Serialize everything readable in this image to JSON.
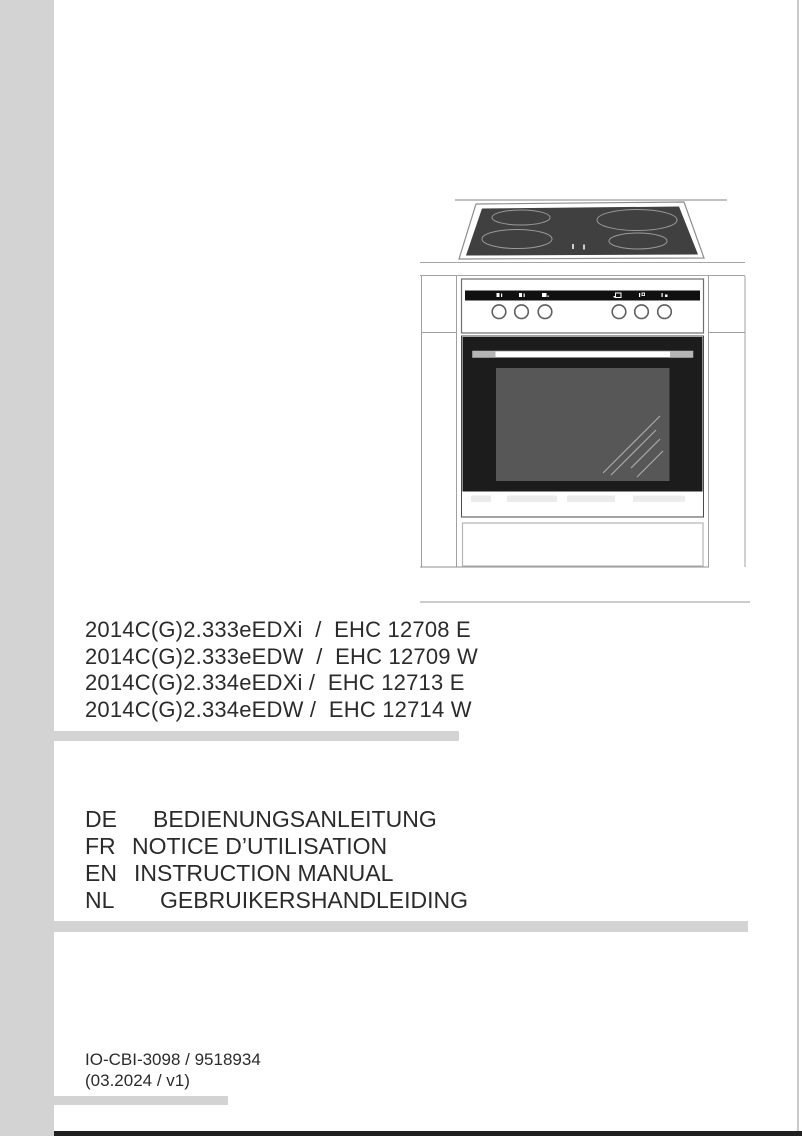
{
  "models": [
    "2014C(G)2.333eEDXi  /  EHC 12708 E",
    "2014C(G)2.333eEDW  /  EHC 12709 W",
    "2014C(G)2.334eEDXi /  EHC 12713 E",
    "2014C(G)2.334eEDW /  EHC 12714 W"
  ],
  "languages": [
    {
      "code": "DE",
      "title": "BEDIENUNGSANLEITUNG"
    },
    {
      "code": "FR",
      "title": "NOTICE D’UTILISATION"
    },
    {
      "code": "EN",
      "title": "INSTRUCTION MANUAL"
    },
    {
      "code": "NL",
      "title": "GEBRUIKERSHANDLEIDING"
    }
  ],
  "document": {
    "number": "IO-CBI-3098 / 9518934",
    "version": "(03.2024 / v1)"
  },
  "colors": {
    "rail_gray": "#d3d3d3",
    "footer_bar": "#202020",
    "door_black": "#1c1c1c",
    "hob_glass": "#404040",
    "window_gray": "#575757"
  },
  "illustration": {
    "subject": "freestanding-cooker-line-drawing",
    "icons": [
      "hob-zone-icon-1",
      "hob-zone-icon-2",
      "hob-zone-icon-3",
      "oven-function-icon",
      "oven-thermostat-icon",
      "oven-timer-icon"
    ]
  }
}
